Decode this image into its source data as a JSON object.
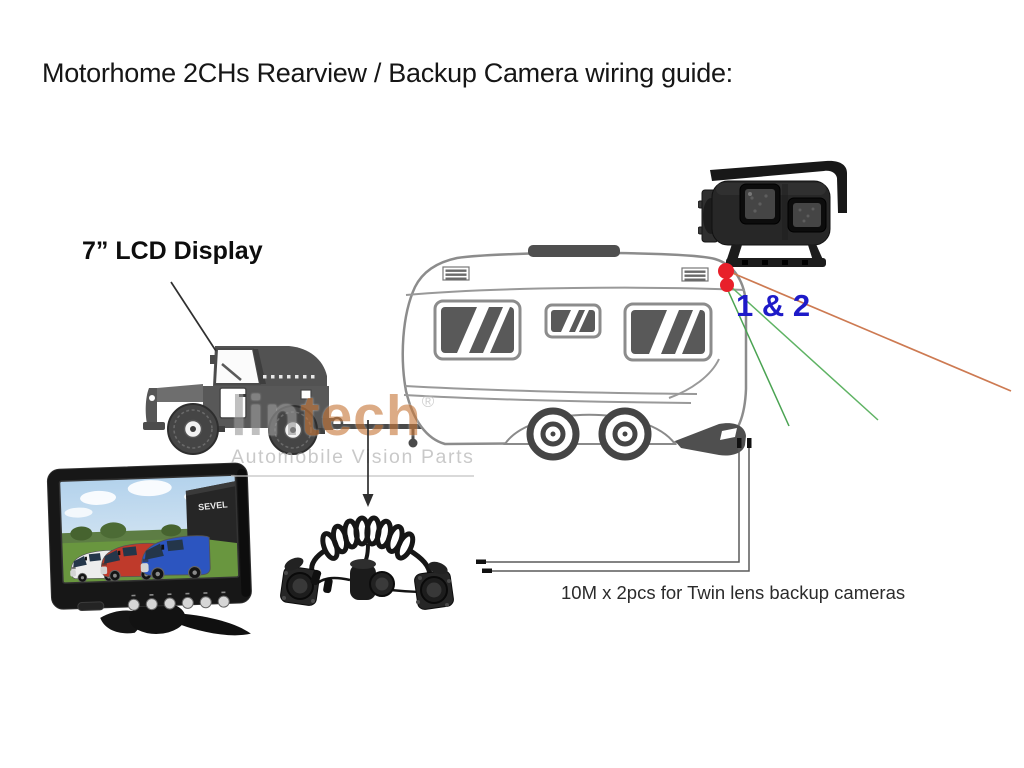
{
  "title": "Motorhome 2CHs Rearview / Backup Camera wiring guide:",
  "labels": {
    "lcd_display": "7” LCD Display",
    "channels": "1 & 2",
    "cable_caption": "10M x 2pcs for Twin lens backup cameras"
  },
  "watermark": {
    "brand_first": "lin",
    "brand_second": "tech",
    "registered": "®",
    "tagline": "Automobile Vision Parts"
  },
  "monitor_screen": {
    "building_sign": "SEVEL"
  },
  "icons": {
    "camera": "twin-lens-backup-camera-illustration",
    "monitor": "lcd-monitor-illustration",
    "vehicle": "truck-towing-caravan-illustration",
    "cable": "coiled-trailer-cable-illustration"
  },
  "colors": {
    "channels_blue": "#1e1ac8",
    "dot_red": "#e8202a",
    "camera_line_orange": "#cd7a52",
    "camera_line_green": "#5fb364",
    "watermark_gray": "#9b9b9b",
    "watermark_orange": "#c8793c",
    "diagram_gray": "#8c8c8c"
  }
}
